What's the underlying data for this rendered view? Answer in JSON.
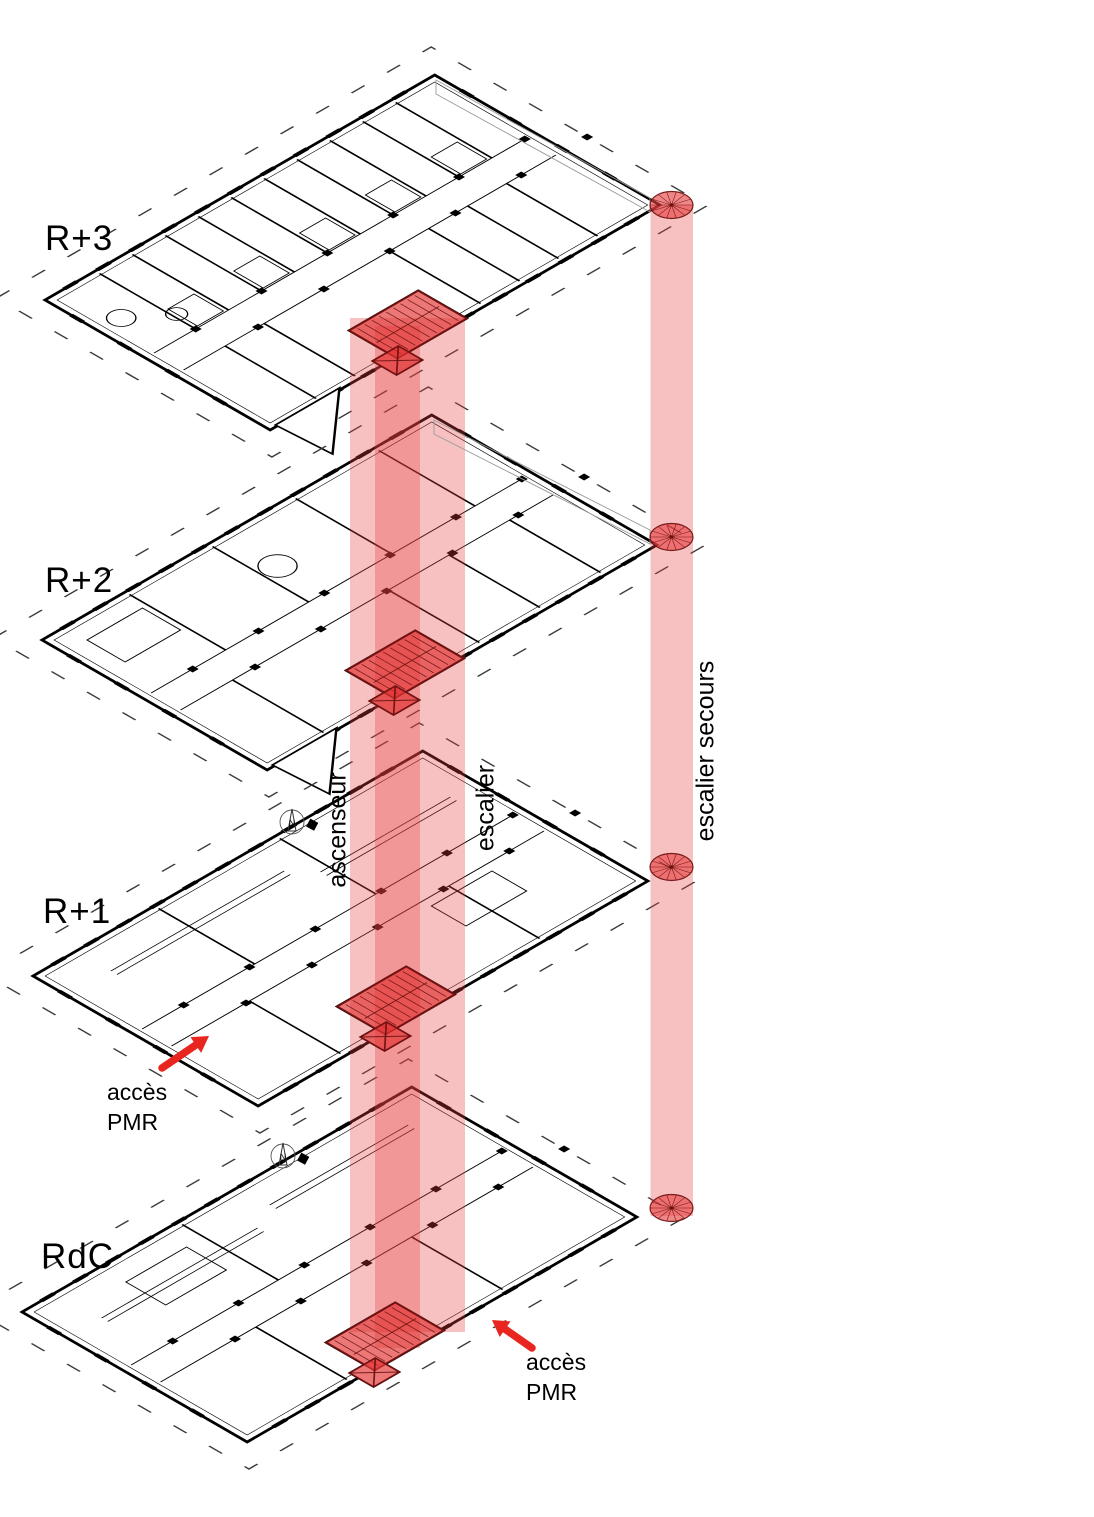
{
  "diagram_title": "exploded axonometric circulation diagram",
  "colors": {
    "plan_line": "#000000",
    "band_red": "#e63e3e",
    "core_red": "#e23030",
    "dark_red": "#6e1111",
    "ellipse_red": "#e63e3e",
    "arrow_red": "#e8251f",
    "leader_gray": "#9a9a9a"
  },
  "floors": [
    {
      "id": "R3",
      "label": "R+3"
    },
    {
      "id": "R2",
      "label": "R+2"
    },
    {
      "id": "R1",
      "label": "R+1"
    },
    {
      "id": "RDC",
      "label": "RdC"
    }
  ],
  "circulation": {
    "ascenseur": {
      "label": "ascenseur"
    },
    "escalier": {
      "label": "escalier"
    },
    "escalier_secours": {
      "label": "escalier secours"
    }
  },
  "annotations": [
    {
      "id": "acces-pmr-r1",
      "line1": "accès",
      "line2": "PMR"
    },
    {
      "id": "acces-pmr-rdc",
      "line1": "accès",
      "line2": "PMR"
    }
  ],
  "compass": {
    "letter": "N"
  }
}
